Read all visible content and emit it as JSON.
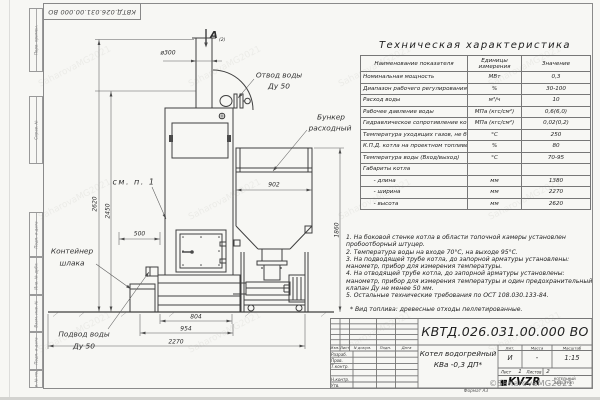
{
  "page": {
    "paper_color": "#f7f7f4",
    "line_color": "#3f3f3f"
  },
  "corner_stamp": {
    "text": "КВТД.026.031.00.000 ВО"
  },
  "frame_labels": [
    "Перв. примен.",
    "Справ. №",
    "Подп. и дата",
    "Инв. № дубл.",
    "Взам. инв. №",
    "Подп. и дата",
    "Инв. № подл."
  ],
  "drawing": {
    "view_label": "А",
    "view_label_sub": "(2)",
    "labels": {
      "water_outlet_1": "Отвод воды",
      "water_outlet_2": "Ду 50",
      "hopper_1": "Бункер",
      "hopper_2": "расходный",
      "see_note": "см. п. 1",
      "slag_1": "Контейнер",
      "slag_2": "шлака",
      "water_inlet_1": "Подвод воды",
      "water_inlet_2": "Ду 50"
    },
    "dims": {
      "chimney_dia": "ø300",
      "hopper_width": "902",
      "right_height": "1860",
      "total_height": "2620",
      "outlet_height": "2450",
      "offset": "500",
      "base_width": "804",
      "boiler_width": "954",
      "overall_width": "2270"
    }
  },
  "spec_table": {
    "title": "Техническая характеристика",
    "headers": [
      "Наименование показателя",
      "Единицы измерения",
      "Значение"
    ],
    "rows": [
      [
        "Номинальная мощность",
        "МВт",
        "0,3"
      ],
      [
        "Диапазон рабочего регулирования",
        "%",
        "30-100"
      ],
      [
        "Расход воды",
        "м³/ч",
        "10"
      ],
      [
        "Рабочее давление воды",
        "МПа (кгс/см²)",
        "0,6(6,0)"
      ],
      [
        "Гидравлическое сопротивление котла",
        "МПа (кгс/см²)",
        "0,02(0,2)"
      ],
      [
        "Температура уходящих газов, не более",
        "°С",
        "250"
      ],
      [
        "К.П.Д. котла на проектном топливе",
        "%",
        "80"
      ],
      [
        "Температура воды (Вход/выход)",
        "°С",
        "70-95"
      ],
      [
        "Габариты котла",
        "",
        ""
      ],
      [
        "      - длина",
        "мм",
        "1380"
      ],
      [
        "      - ширина",
        "мм",
        "2270"
      ],
      [
        "      - высота",
        "мм",
        "2620"
      ]
    ]
  },
  "notes": {
    "lines": [
      "1. На боковой стенке котла в области топочной камеры установлен",
      "пробоотборный штуцер.",
      "2. Температура воды на входе 70°С, на выходе 95°С.",
      "3. На подводящей трубе котла, до запорной арматуры установлены:",
      "манометр, прибор для измерения температуры.",
      "4. На отводящей трубе котла, до запорной арматуры установлены:",
      "манометр, прибор для измерения температуры и один предохранительный",
      "клапан Ду не менее 50 мм.",
      "5. Остальные технические требования по ОСТ 108.030.133-84."
    ],
    "fuel": "* Вид топлива: древесные отходы пеллетированные."
  },
  "title_block": {
    "designation": "КВТД.026.031.00.000 ВО",
    "product_line1": "Котел водогрейный",
    "product_line2": "КВа -0,3 ДП*",
    "header_cols": [
      "Изм.",
      "Лист",
      "N докум.",
      "Подп.",
      "Дата"
    ],
    "roles": [
      "Разраб.",
      "Пров.",
      "Т.контр.",
      "Н.контр.",
      "Утв."
    ],
    "lit_label": "Лит.",
    "lit_value": "И",
    "mass_label": "Масса",
    "mass_value": "-",
    "scale_label": "Масштаб",
    "scale_value": "1:15",
    "sheet_label": "Лист",
    "sheet_value": "1",
    "sheets_label": "Листов",
    "sheets_value": "2",
    "logo_text": "KVZR",
    "company_line1": "КОТЕЛЬНЫЙ",
    "company_line2": "ЗАВОД РЭП",
    "format_note": "Формат А3"
  },
  "watermarks": {
    "tile": "SaharovaMG2021",
    "main": "©SaharovaMG2021"
  }
}
